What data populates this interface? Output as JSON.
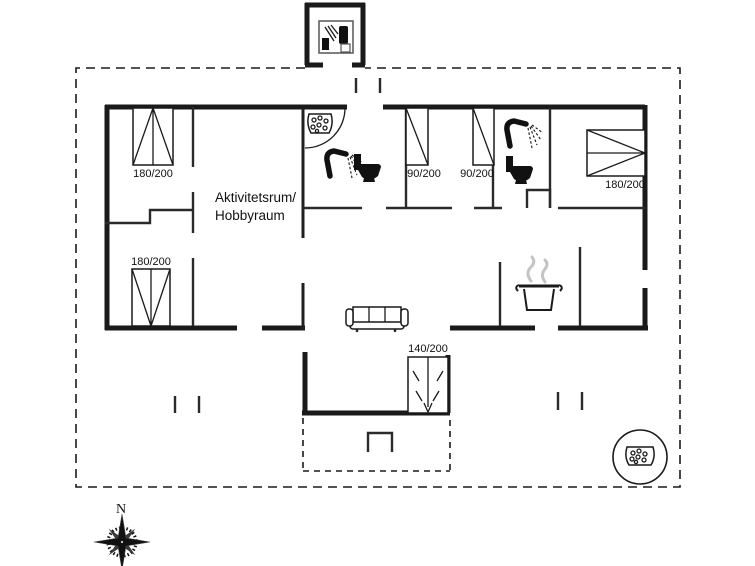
{
  "floorplan": {
    "room_labels": {
      "activity_room_line1": "Aktivitetsrum/",
      "activity_room_line2": "Hobbyraum"
    },
    "beds": [
      {
        "name": "bed-double-top-left",
        "label": "180/200"
      },
      {
        "name": "bed-double-bottom-left",
        "label": "180/200"
      },
      {
        "name": "bed-single-1",
        "label": "90/200"
      },
      {
        "name": "bed-single-2",
        "label": "90/200"
      },
      {
        "name": "bed-double-right",
        "label": "180/200"
      },
      {
        "name": "bed-alcove",
        "label": "140/200"
      }
    ],
    "compass": {
      "north_label": "N"
    },
    "icons": {
      "whirlpool": "whirlpool-bubble-tub",
      "shower": "shower-head-spray",
      "toilet": "toilet-silhouette",
      "sofa": "three-seat-sofa",
      "cooking_pot": "cooking-pot-with-steam",
      "hot_tub": "outdoor-hot-tub-circle",
      "annex": "annex-shower-toilet",
      "compass_rose": "compass-rose"
    },
    "colors": {
      "wall": "#1a1a1a",
      "background": "#ffffff",
      "steam": "#c4c4c4"
    }
  }
}
